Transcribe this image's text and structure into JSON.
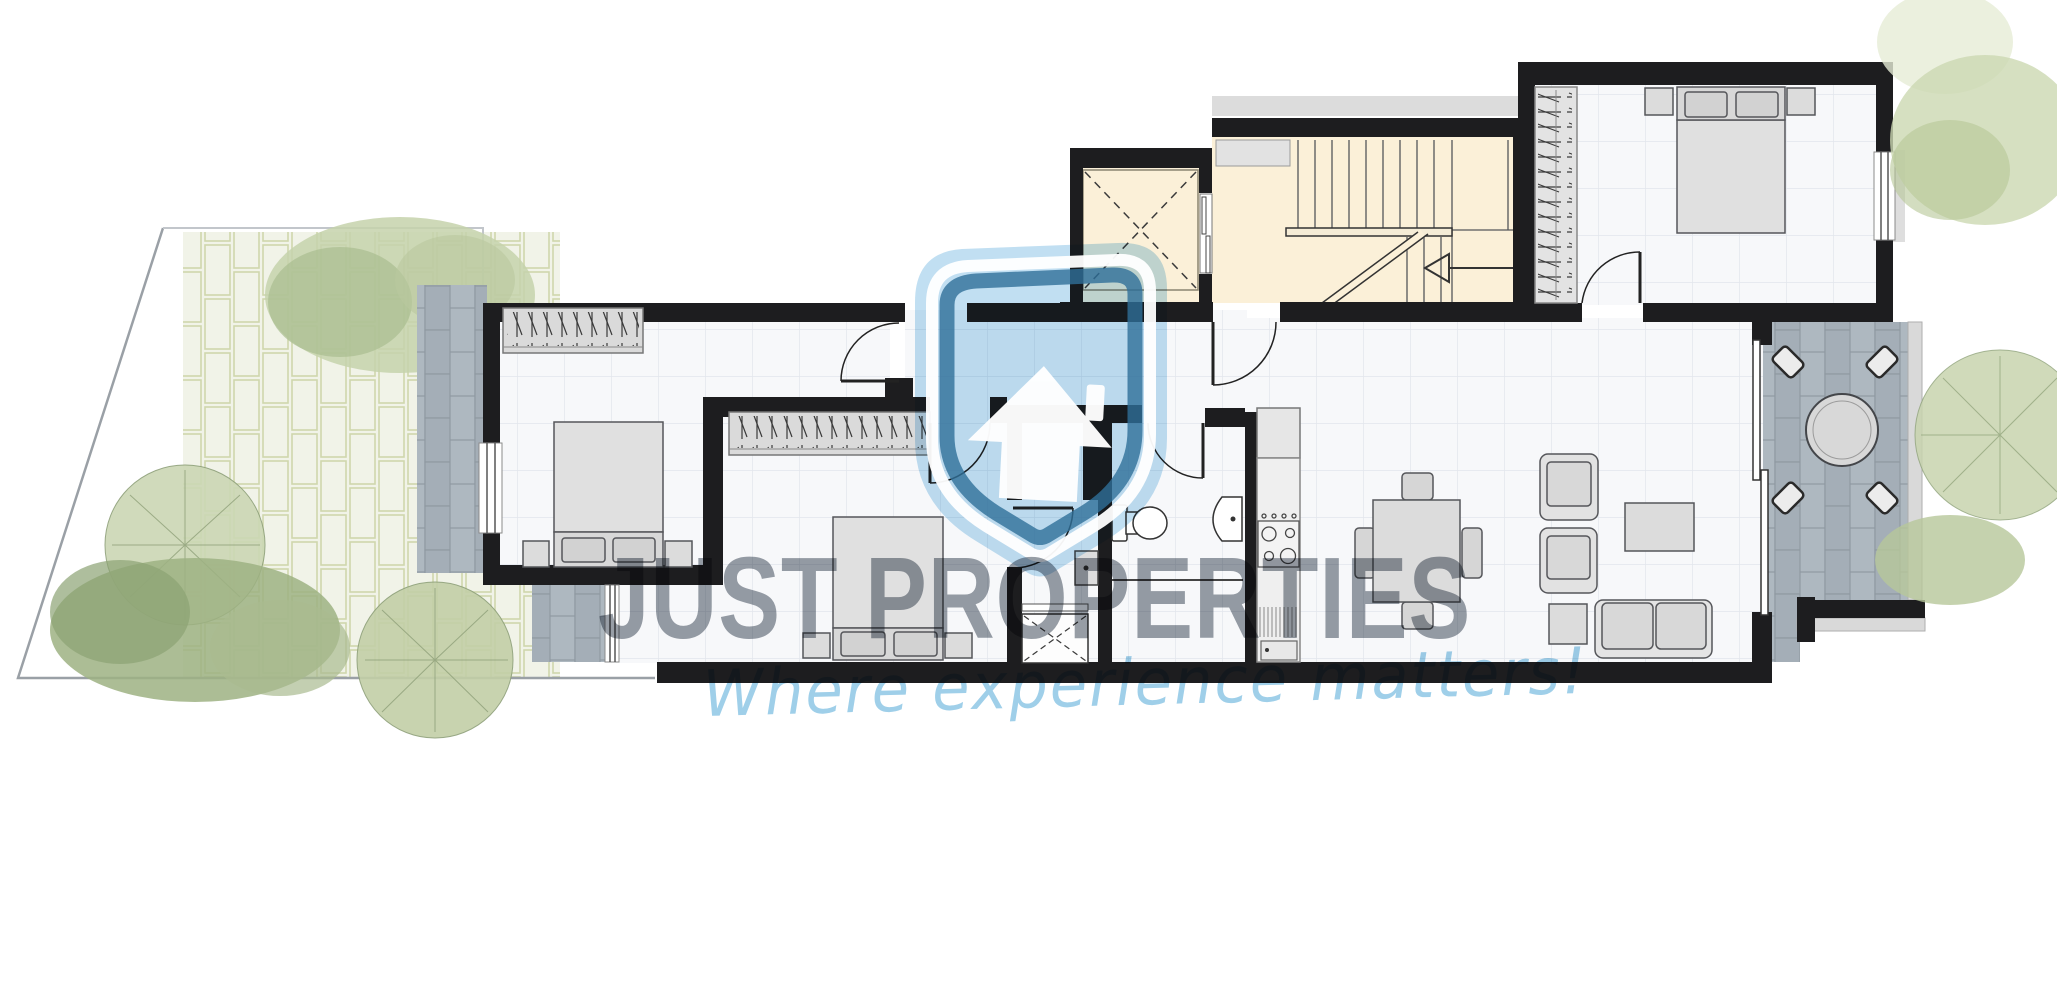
{
  "watermark": {
    "brand": "JUST PROPERTIES",
    "tagline": "Where experience matters!",
    "logo_icon": "shield-house-icon"
  },
  "palette": {
    "wall": "#1d1d1f",
    "floor_tile": "#f7f8fa",
    "tile_grid": "#e2e6ec",
    "stair_beige": "#fbf0d8",
    "balcony_tile": "#aab4bc",
    "garden_brick": "#f0f2e6",
    "tree_green": "#c6d2ab",
    "brand_blue": "#badcf1",
    "brand_blue_dark": "#2f6f99",
    "watermark_gray": "#989ea6",
    "tagline_blue": "#9fcfe9",
    "furniture_gray": "#dcdcdc"
  }
}
